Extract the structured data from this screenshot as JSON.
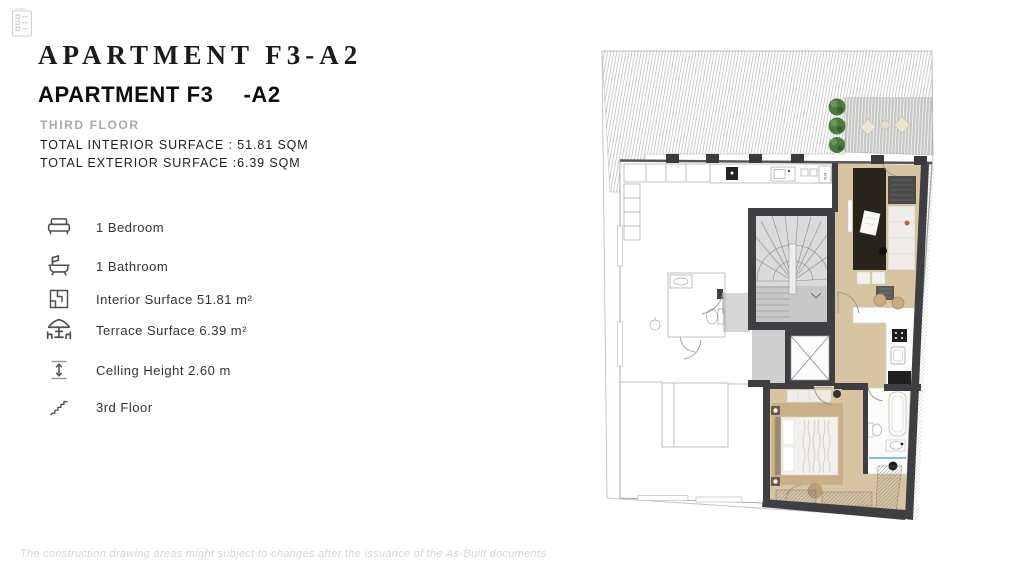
{
  "header": {
    "icon": "checklist-icon",
    "title": "APARTMENT F3-A2",
    "subtitle_name": "APARTMENT F3",
    "subtitle_unit": "-A2",
    "floor_label": "THIRD FLOOR",
    "interior_surface": "TOTAL INTERIOR SURFACE : 51.81 SQM",
    "exterior_surface": "TOTAL EXTERIOR SURFACE :6.39 SQM"
  },
  "features": [
    {
      "icon": "bed-icon",
      "label": "1 Bedroom"
    },
    {
      "icon": "bath-icon",
      "label": "1 Bathroom"
    },
    {
      "icon": "floorplan-icon",
      "label": "Interior Surface 51.81 m²"
    },
    {
      "icon": "terrace-icon",
      "label": "Terrace Surface 6.39 m²"
    },
    {
      "icon": "height-icon",
      "label": "Celling Height 2.60 m"
    },
    {
      "icon": "stairs-icon",
      "label": "3rd Floor"
    }
  ],
  "floor_plan": {
    "wm_label": "W.M.",
    "colors": {
      "unit_floor": "#d7c4a3",
      "bedroom_rug": "#c9ae87",
      "dark_rug": "#29231e",
      "wall": "#3e3e43",
      "stair_fill": "#d9d9d9",
      "terrace_deck": "#c6c8c6",
      "tree": "#4e7a40",
      "shower_glass": "#86bdd9"
    }
  },
  "footer": {
    "disclaimer": "The construction drawing areas might subject to changes after the issuance of the As-Built documents"
  }
}
